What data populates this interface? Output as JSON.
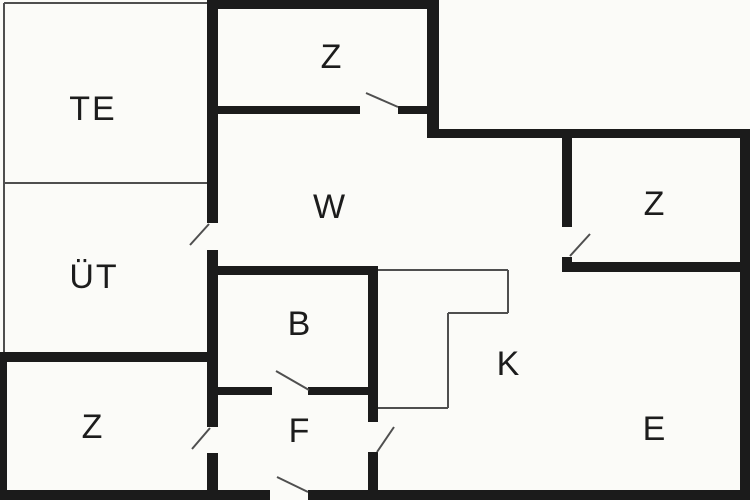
{
  "canvas": {
    "width": 750,
    "height": 500,
    "background": "#fbfbf8",
    "wall_color": "#1b1b1b",
    "thin_line_color": "#4f4f4f",
    "door_color": "#4f4f4f",
    "label_color": "#1c1c1c"
  },
  "rooms": [
    {
      "id": "te",
      "label": "TE",
      "x": 93,
      "y": 111
    },
    {
      "id": "ut",
      "label": "ÜT",
      "x": 94,
      "y": 279
    },
    {
      "id": "z-top",
      "label": "Z",
      "x": 332,
      "y": 59
    },
    {
      "id": "w",
      "label": "W",
      "x": 330,
      "y": 209
    },
    {
      "id": "z-right",
      "label": "Z",
      "x": 655,
      "y": 206
    },
    {
      "id": "b",
      "label": "B",
      "x": 300,
      "y": 326
    },
    {
      "id": "k",
      "label": "K",
      "x": 509,
      "y": 366
    },
    {
      "id": "f",
      "label": "F",
      "x": 300,
      "y": 433
    },
    {
      "id": "z-bottom-left",
      "label": "Z",
      "x": 93,
      "y": 429
    },
    {
      "id": "e",
      "label": "E",
      "x": 655,
      "y": 431
    }
  ],
  "walls": [
    {
      "name": "outer-top",
      "x": 207,
      "y": 0,
      "w": 231,
      "h": 9
    },
    {
      "name": "notch-vertical",
      "x": 427,
      "y": 0,
      "w": 12,
      "h": 138
    },
    {
      "name": "outer-upper-right",
      "x": 427,
      "y": 129,
      "w": 323,
      "h": 9
    },
    {
      "name": "outer-right",
      "x": 740,
      "y": 129,
      "w": 10,
      "h": 371
    },
    {
      "name": "outer-bottom-left",
      "x": 0,
      "y": 490,
      "w": 270,
      "h": 10
    },
    {
      "name": "outer-bottom-right",
      "x": 308,
      "y": 490,
      "w": 442,
      "h": 10
    },
    {
      "name": "outer-left-lower",
      "x": 0,
      "y": 352,
      "w": 7,
      "h": 148
    },
    {
      "name": "ut-z-divider",
      "x": 0,
      "y": 352,
      "w": 218,
      "h": 10
    },
    {
      "name": "spine-upper",
      "x": 207,
      "y": 0,
      "w": 11,
      "h": 223
    },
    {
      "name": "spine-middle",
      "x": 207,
      "y": 250,
      "w": 11,
      "h": 177
    },
    {
      "name": "spine-lower",
      "x": 207,
      "y": 453,
      "w": 11,
      "h": 37
    },
    {
      "name": "z-top-bottom-left",
      "x": 218,
      "y": 106,
      "w": 142,
      "h": 8
    },
    {
      "name": "z-top-bottom-right",
      "x": 398,
      "y": 106,
      "w": 29,
      "h": 8
    },
    {
      "name": "z-right-left-upper",
      "x": 562,
      "y": 138,
      "w": 10,
      "h": 89
    },
    {
      "name": "z-right-left-stub",
      "x": 562,
      "y": 257,
      "w": 10,
      "h": 15
    },
    {
      "name": "z-right-bottom",
      "x": 562,
      "y": 262,
      "w": 188,
      "h": 10
    },
    {
      "name": "b-top",
      "x": 218,
      "y": 266,
      "w": 160,
      "h": 9
    },
    {
      "name": "bf-right-upper",
      "x": 368,
      "y": 266,
      "w": 10,
      "h": 156
    },
    {
      "name": "bf-right-lower",
      "x": 368,
      "y": 452,
      "w": 10,
      "h": 38
    },
    {
      "name": "bf-divider-left",
      "x": 218,
      "y": 387,
      "w": 54,
      "h": 8
    },
    {
      "name": "bf-divider-right",
      "x": 308,
      "y": 387,
      "w": 60,
      "h": 8
    }
  ],
  "thin_lines": [
    {
      "name": "te-left",
      "x1": 4,
      "y1": 3,
      "x2": 4,
      "y2": 352
    },
    {
      "name": "te-top",
      "x1": 4,
      "y1": 3,
      "x2": 207,
      "y2": 3
    },
    {
      "name": "te-ut-divider",
      "x1": 4,
      "y1": 183,
      "x2": 207,
      "y2": 183
    },
    {
      "name": "counter-top",
      "x1": 378,
      "y1": 270,
      "x2": 508,
      "y2": 270
    },
    {
      "name": "counter-right-upper",
      "x1": 508,
      "y1": 270,
      "x2": 508,
      "y2": 313
    },
    {
      "name": "counter-step",
      "x1": 448,
      "y1": 313,
      "x2": 508,
      "y2": 313
    },
    {
      "name": "counter-right-lower",
      "x1": 448,
      "y1": 313,
      "x2": 448,
      "y2": 408
    },
    {
      "name": "counter-bottom",
      "x1": 378,
      "y1": 408,
      "x2": 448,
      "y2": 408
    }
  ],
  "door_swings": [
    {
      "name": "door-z-top",
      "x1": 398,
      "y1": 107,
      "x2": 366,
      "y2": 93
    },
    {
      "name": "door-ut",
      "x1": 209,
      "y1": 224,
      "x2": 190,
      "y2": 245
    },
    {
      "name": "door-z-right",
      "x1": 570,
      "y1": 256,
      "x2": 590,
      "y2": 234
    },
    {
      "name": "door-b",
      "x1": 309,
      "y1": 390,
      "x2": 276,
      "y2": 371
    },
    {
      "name": "door-f-k",
      "x1": 377,
      "y1": 452,
      "x2": 394,
      "y2": 427
    },
    {
      "name": "door-z-bottom-left",
      "x1": 210,
      "y1": 428,
      "x2": 192,
      "y2": 449
    },
    {
      "name": "door-entrance",
      "x1": 308,
      "y1": 492,
      "x2": 277,
      "y2": 477
    }
  ]
}
